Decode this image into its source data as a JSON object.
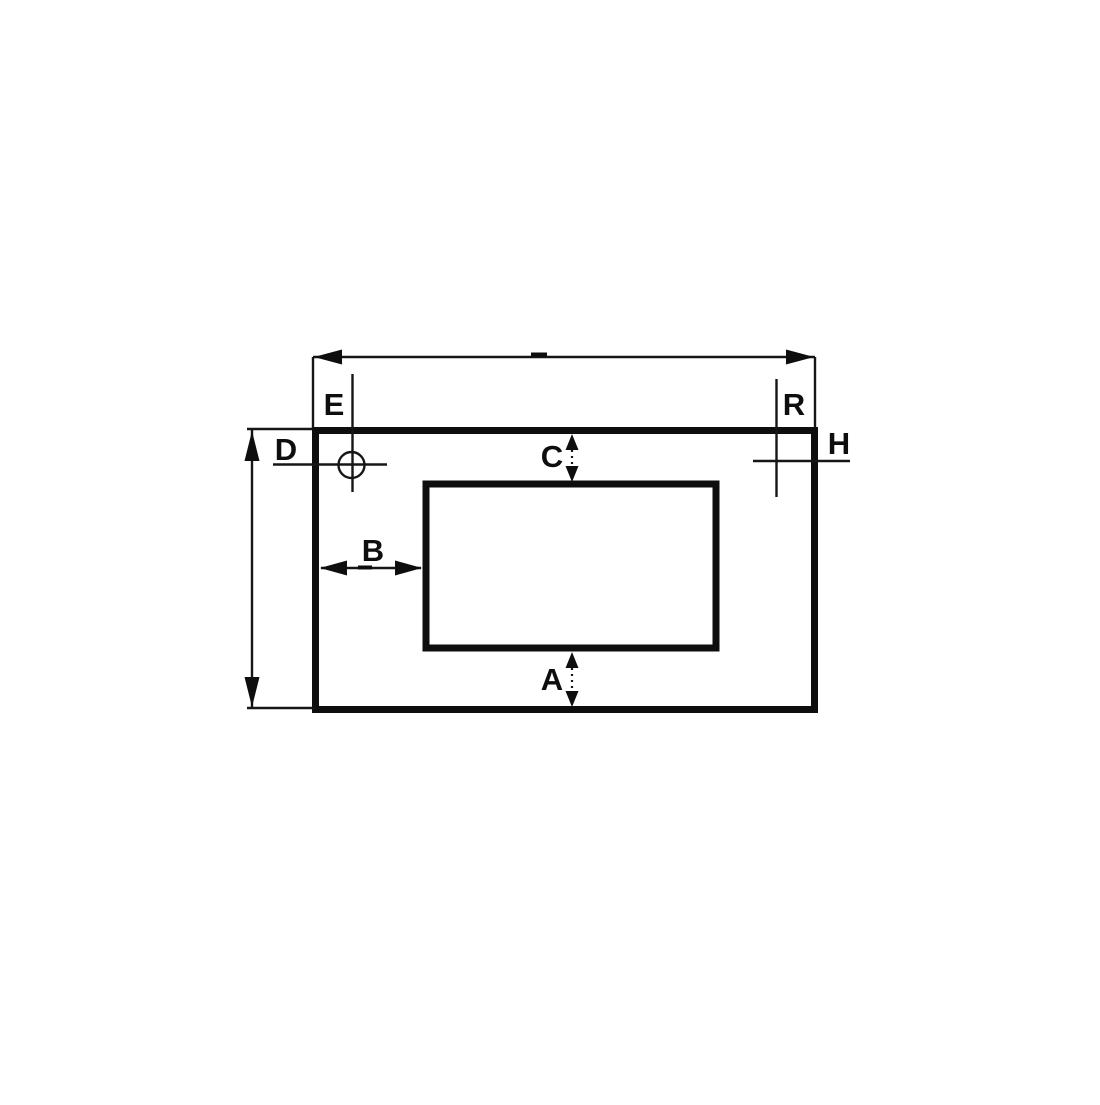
{
  "diagram": {
    "type": "engineering-dimension-drawing",
    "background_color": "#ffffff",
    "line_color": "#0e0e0e",
    "labels": {
      "A": "A",
      "B": "B",
      "C": "C",
      "D": "D",
      "E": "E",
      "H": "H",
      "R": "R"
    }
  }
}
